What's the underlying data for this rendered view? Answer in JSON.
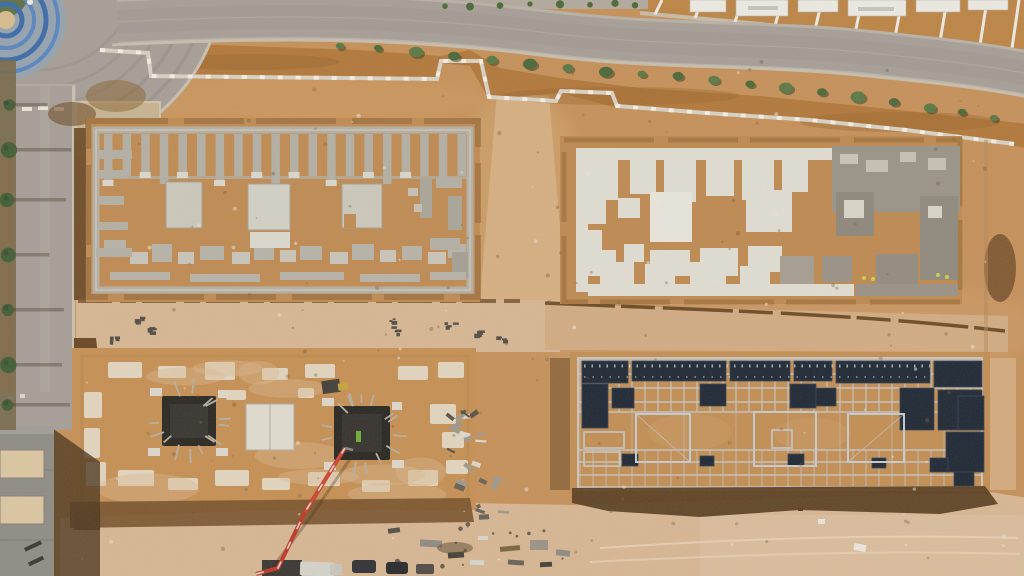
{
  "scene": {
    "title": "Aerial drone photograph of a construction site",
    "description": "Top-down view: four rectangular building foundations in desert sand, perimeter roads with shrubs at top and left, a roundabout with a blue playground at top-left corner, white houses under construction at top-right, a building at bottom-left, and a concrete pump truck with a red boom at bottom center.",
    "features": [
      "curved-top-road",
      "left-road-with-trees",
      "roundabout",
      "blue-playground",
      "white-houses-top-right",
      "stepped-site-boundary-wall",
      "foundation-plot-top-left-strip-footings",
      "foundation-plot-top-right-white-slabs",
      "foundation-plot-bottom-left-pits",
      "foundation-plot-bottom-right-rebar-grid",
      "excavation-trenches",
      "concrete-pump-truck-red-boom",
      "parked-vehicles",
      "material-stacks",
      "small-building-bottom-left"
    ]
  },
  "palette": {
    "sand": "#C6925C",
    "sandLight": "#D6B083",
    "sandPale": "#DFC6A5",
    "sandPink": "#D7B795",
    "dirt": "#B27A3E",
    "trench": "#6F4E2B",
    "spoil": "#7A5530",
    "road": "#A7A098",
    "roadLight": "#B8B2A8",
    "curb": "#C8C1B2",
    "pad": "#C7B493",
    "concrete": "#B4B0A6",
    "concreteLight": "#CCC8BD",
    "slabWhite": "#E0DDD3",
    "slabBright": "#E8E5DC",
    "formDark": "#9B958A",
    "navy": "#222B38",
    "steel": "#C7CBD0",
    "green": "#4E6A3C",
    "greenDark": "#3C5230",
    "blue": "#3E6DAA",
    "blueLight": "#5B87C0",
    "red": "#BF3A2C",
    "white": "#ECEAE4",
    "roof": "#908E88",
    "wallTan": "#DBC7A4",
    "shadowDark": "#4F3A22"
  },
  "generators": {
    "plotA_strip_count": 20,
    "gridD_vertical_count": 31,
    "shrub_count": 19,
    "tree_count": 7,
    "speckle_count": 170
  }
}
